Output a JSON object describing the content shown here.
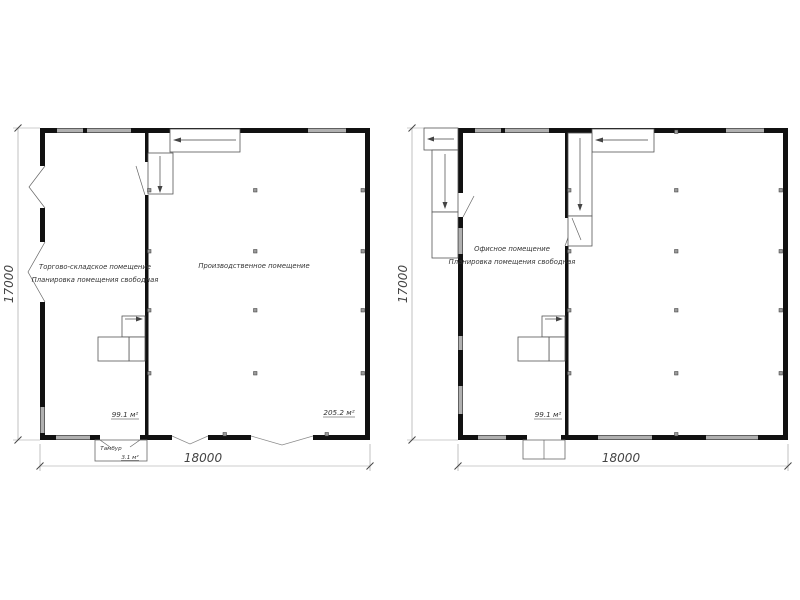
{
  "drawing": {
    "plans": [
      {
        "id": "floor-1",
        "rooms": [
          {
            "name": "Торгово-складское помещение",
            "note": "Планировка помещения свободная",
            "area": "99.1 м²"
          },
          {
            "name": "Производственное помещение",
            "area": "205.2 м²"
          }
        ],
        "vestibule": {
          "name": "Тамбур",
          "area": "3.1 м²"
        },
        "dimensions": {
          "height": "17000",
          "width": "18000"
        }
      },
      {
        "id": "floor-2",
        "rooms": [
          {
            "name": "Офисное помещение",
            "note": "Планировка помещения свободная",
            "area": "99.1 м²"
          }
        ],
        "dimensions": {
          "height": "17000",
          "width": "18000"
        }
      }
    ]
  },
  "colors": {
    "wall": "#111111",
    "window": "#b0b0b0",
    "dimension_line": "#999999",
    "text": "#333333",
    "background": "#ffffff"
  }
}
